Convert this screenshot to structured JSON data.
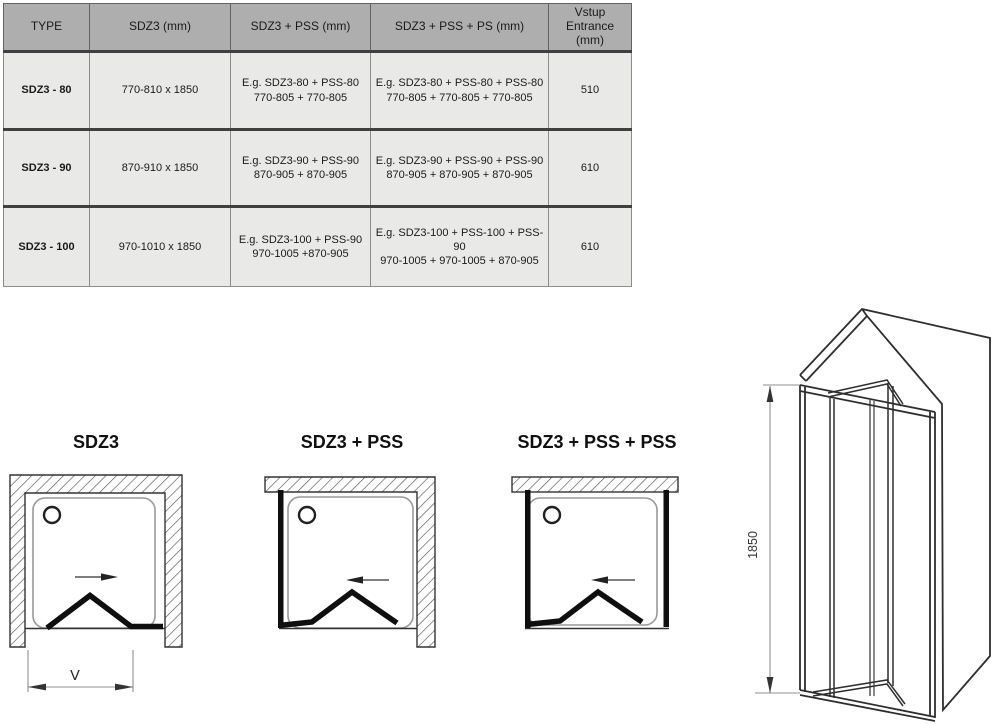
{
  "table": {
    "columns": [
      "TYPE",
      "SDZ3 (mm)",
      "SDZ3 + PSS (mm)",
      "SDZ3 + PSS + PS (mm)",
      "Vstup Entrance (mm)"
    ],
    "rows": [
      {
        "type": "SDZ3 - 80",
        "size": "770-810 x 1850",
        "pss_desc": "E.g. SDZ3-80 + PSS-80",
        "pss_sizes": "770-805 + 770-805",
        "pss2_desc": "E.g. SDZ3-80 + PSS-80 + PSS-80",
        "pss2_sizes": "770-805 + 770-805 + 770-805",
        "entrance": "510"
      },
      {
        "type": "SDZ3 - 90",
        "size": "870-910 x 1850",
        "pss_desc": "E.g. SDZ3-90 + PSS-90",
        "pss_sizes": "870-905 + 870-905",
        "pss2_desc": "E.g. SDZ3-90 + PSS-90 + PSS-90",
        "pss2_sizes": "870-905 + 870-905 + 870-905",
        "entrance": "610"
      },
      {
        "type": "SDZ3 - 100",
        "size": "970-1010 x 1850",
        "pss_desc": "E.g. SDZ3-100 + PSS-90",
        "pss_sizes": "970-1005 +870-905",
        "pss2_desc": "E.g. SDZ3-100 + PSS-100 + PSS-90",
        "pss2_sizes": "970-1005 + 970-1005 + 870-905",
        "entrance": "610"
      }
    ]
  },
  "diagrams": {
    "plan": [
      {
        "title": "SDZ3"
      },
      {
        "title": "SDZ3 + PSS"
      },
      {
        "title": "SDZ3 + PSS + PSS"
      }
    ],
    "entrance_dim_label": "V",
    "height_dim_label": "1850"
  },
  "colors": {
    "header_bg": "#aeaeae",
    "cell_bg": "#e9e9e7",
    "line": "#333333",
    "door_line": "#0f0f0f",
    "dim_line": "#909090"
  }
}
